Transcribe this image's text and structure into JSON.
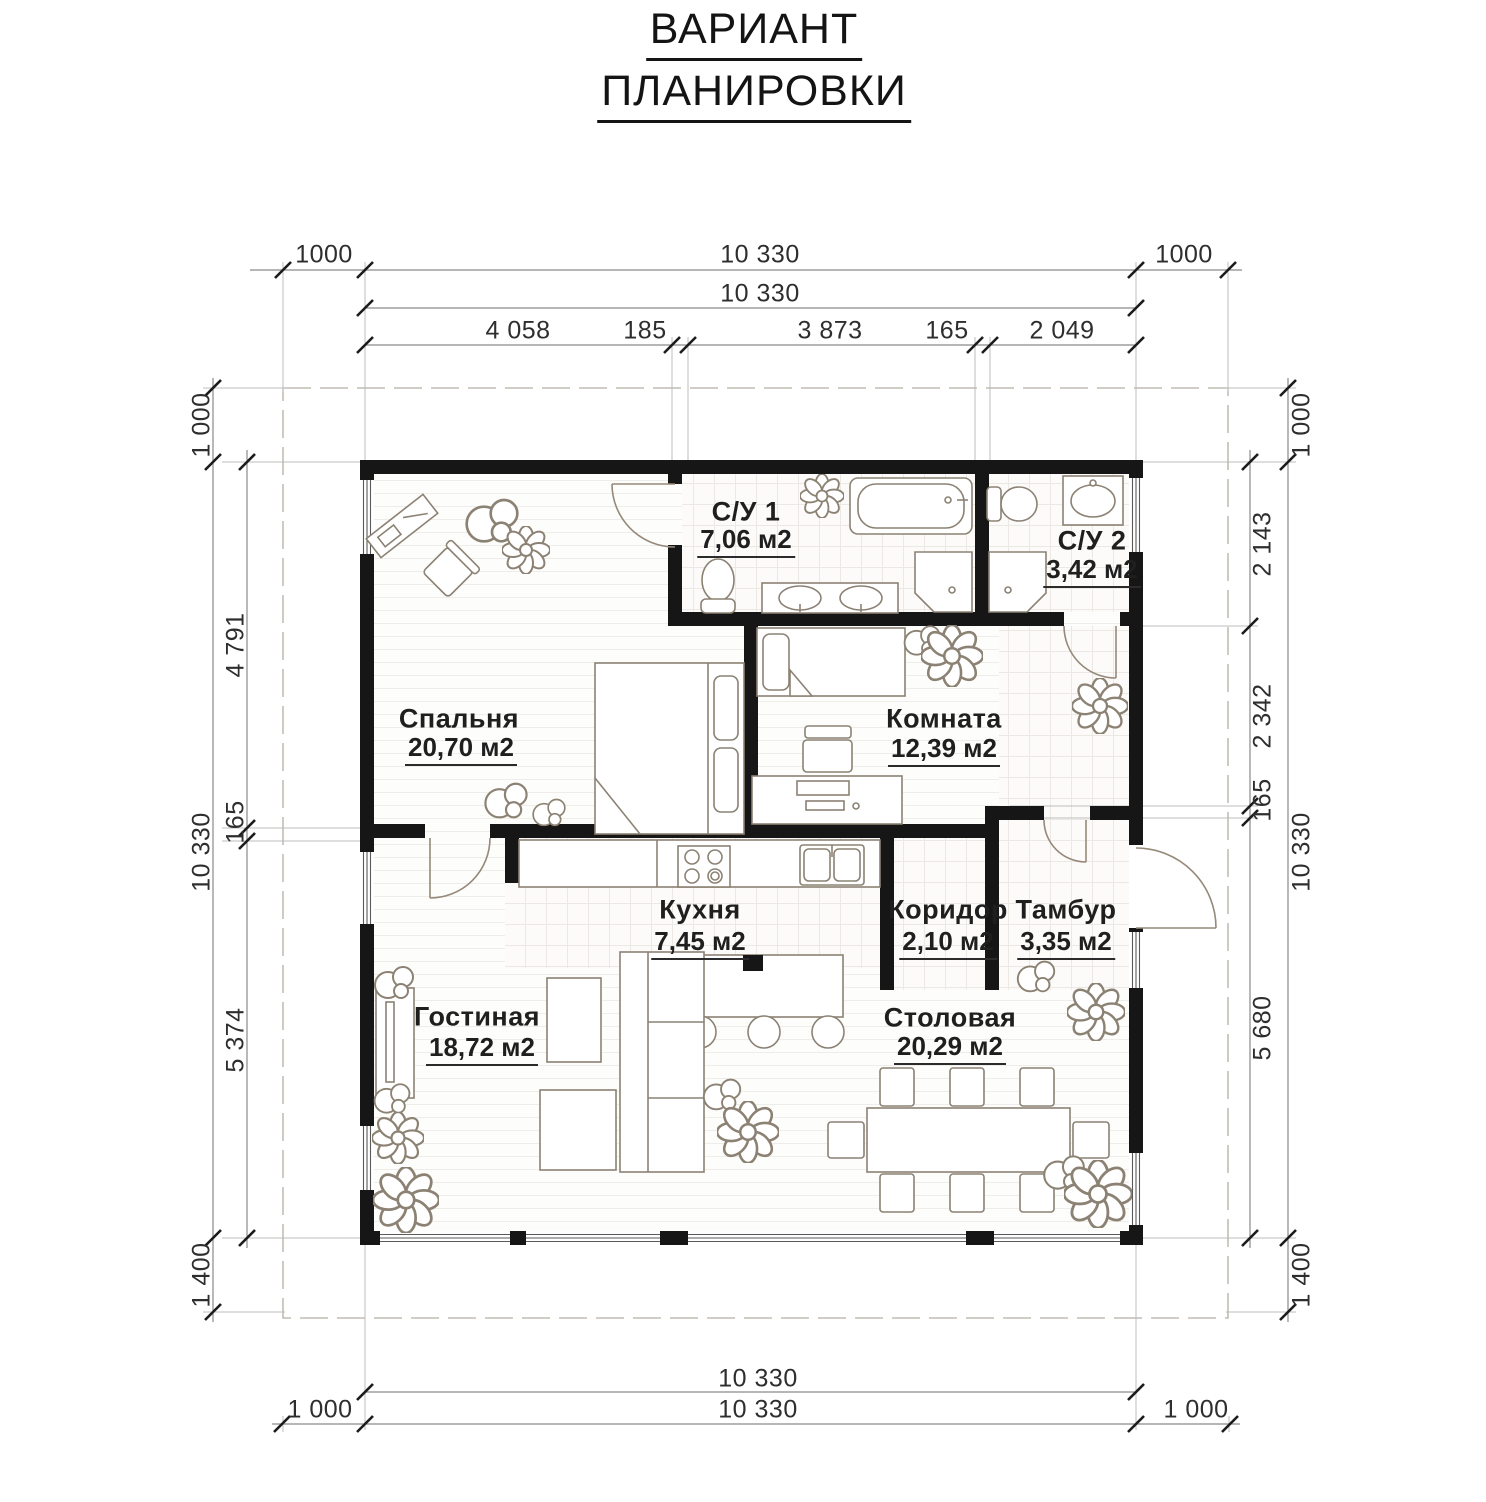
{
  "title": {
    "line1": "ВАРИАНТ",
    "line2": "ПЛАНИРОВКИ"
  },
  "rooms": [
    {
      "name": "Спальня",
      "area": "20,70 м2"
    },
    {
      "name": "С/У 1",
      "area": "7,06 м2"
    },
    {
      "name": "С/У 2",
      "area": "3,42 м2"
    },
    {
      "name": "Комната",
      "area": "12,39 м2"
    },
    {
      "name": "Кухня",
      "area": "7,45 м2"
    },
    {
      "name": "Коридор",
      "area": "2,10 м2"
    },
    {
      "name": "Тамбур",
      "area": "3,35 м2"
    },
    {
      "name": "Гостиная",
      "area": "18,72 м2"
    },
    {
      "name": "Столовая",
      "area": "20,29 м2"
    }
  ],
  "dims": {
    "top_row1": [
      "1000",
      "10 330",
      "1000"
    ],
    "top_row2": "10 330",
    "top_row3": [
      "4 058",
      "185",
      "3 873",
      "165",
      "2 049"
    ],
    "bottom_row1": "10 330",
    "bottom_row2": [
      "1 000",
      "10 330",
      "1 000"
    ],
    "left_outer": [
      "1 000",
      "10 330",
      "1 400"
    ],
    "left_inner": [
      "4 791",
      "165",
      "5 374"
    ],
    "right_outer": [
      "1 000",
      "10 330",
      "1 400"
    ],
    "right_inner": [
      "2 143",
      "2 342",
      "165",
      "5 680"
    ]
  },
  "colors": {
    "wall": "#161616",
    "furniture_line": "#8c8274",
    "dimension_line": "#8a8a8a",
    "text": "#1f1f1f"
  }
}
